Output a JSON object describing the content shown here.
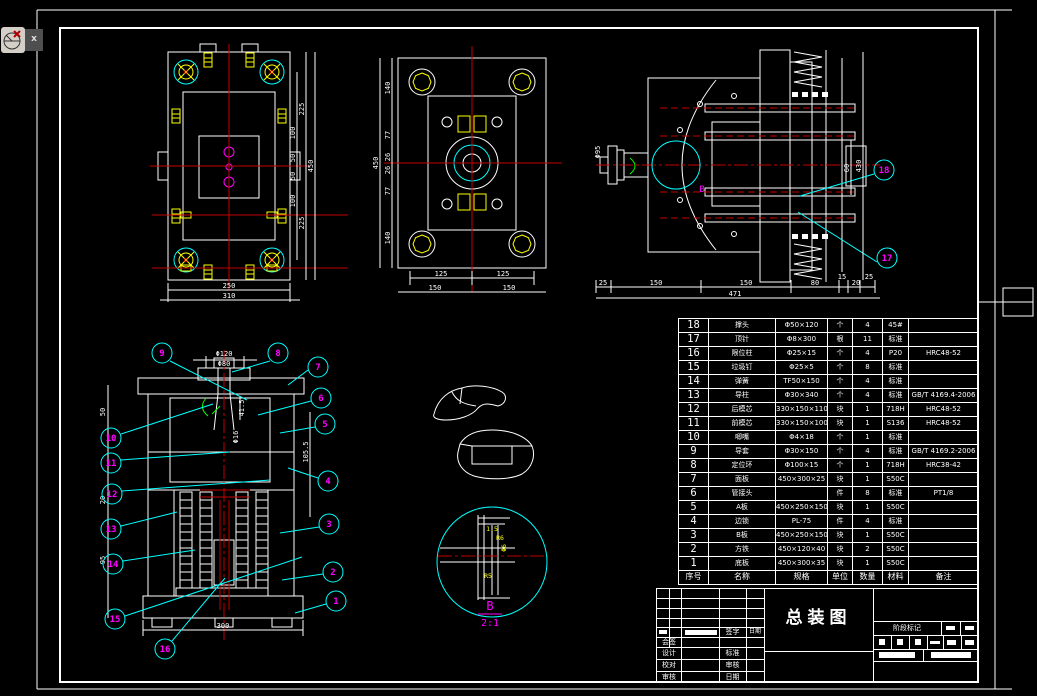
{
  "window": {
    "close_button": "x"
  },
  "views": {
    "plan_view_1": {
      "dim_bottom_inner": "250",
      "dim_bottom_outer": "310",
      "dims_right_chain": [
        "100",
        "50",
        "50",
        "100"
      ],
      "dims_right_mid": [
        "225",
        "225"
      ],
      "dim_right_total": "450"
    },
    "plan_view_2": {
      "dims_left_chain": [
        "140",
        "77",
        "26",
        "26",
        "77",
        "140"
      ],
      "dim_left_total": "450",
      "dims_bottom_inner": [
        "125",
        "125"
      ],
      "dims_bottom_outer": [
        "150",
        "150"
      ]
    },
    "section_view": {
      "dims_bottom_chain": [
        "25",
        "150",
        "150",
        "80",
        "15",
        "20",
        "25"
      ],
      "dim_bottom_total": "471",
      "dim_right_1": "60",
      "dim_right_2": "430",
      "dim_left": "Φ95",
      "detail_label": "B",
      "balloons": {
        "b17": "17",
        "b18": "18"
      }
    },
    "front_view": {
      "dim_top_1": "Φ120",
      "dim_top_2": "Φ80",
      "dim_side_right": "105.5",
      "dim_inner_1": "41.5",
      "dim_inner_2": "Φ16",
      "dim_bottom": "300",
      "dims_left": [
        "50",
        "20",
        "95"
      ],
      "balloons": {
        "b1": "1",
        "b2": "2",
        "b3": "3",
        "b4": "4",
        "b5": "5",
        "b6": "6",
        "b7": "7",
        "b8": "8",
        "b9": "9",
        "b10": "10",
        "b11": "11",
        "b12": "12",
        "b13": "13",
        "b14": "14",
        "b15": "15",
        "b16": "16"
      }
    },
    "detail_view": {
      "label": "B",
      "scale": "2:1",
      "dims": [
        "1.5",
        "R6",
        "Φ6",
        "R5"
      ]
    }
  },
  "parts_table": {
    "headers": [
      "序号",
      "名称",
      "规格",
      "单位",
      "数量",
      "材料",
      "备注"
    ],
    "rows": [
      [
        "18",
        "撑头",
        "Φ50×120",
        "个",
        "4",
        "45#",
        ""
      ],
      [
        "17",
        "顶针",
        "Φ8×300",
        "根",
        "11",
        "标准",
        ""
      ],
      [
        "16",
        "限位柱",
        "Φ25×15",
        "个",
        "4",
        "P20",
        "HRC48-52"
      ],
      [
        "15",
        "垃圾钉",
        "Φ25×5",
        "个",
        "8",
        "标准",
        ""
      ],
      [
        "14",
        "弹簧",
        "TF50×150",
        "个",
        "4",
        "标准",
        ""
      ],
      [
        "13",
        "导柱",
        "Φ30×340",
        "个",
        "4",
        "标准",
        "GB/T 4169.4-2006"
      ],
      [
        "12",
        "后模芯",
        "330×150×110",
        "块",
        "1",
        "718H",
        "HRC48-52"
      ],
      [
        "11",
        "前模芯",
        "330×150×100",
        "块",
        "1",
        "S136",
        "HRC48-52"
      ],
      [
        "10",
        "唧嘴",
        "Φ4×18",
        "个",
        "1",
        "标准",
        ""
      ],
      [
        "9",
        "导套",
        "Φ30×150",
        "个",
        "4",
        "标准",
        "GB/T 4169.2-2006"
      ],
      [
        "8",
        "定位环",
        "Φ100×15",
        "个",
        "1",
        "718H",
        "HRC38-42"
      ],
      [
        "7",
        "面板",
        "450×300×25",
        "块",
        "1",
        "S50C",
        ""
      ],
      [
        "6",
        "管接头",
        "",
        "件",
        "8",
        "标准",
        "PT1/8"
      ],
      [
        "5",
        "A板",
        "450×250×150",
        "块",
        "1",
        "S50C",
        ""
      ],
      [
        "4",
        "边锁",
        "PL-75",
        "件",
        "4",
        "标准",
        ""
      ],
      [
        "3",
        "B板",
        "450×250×150",
        "块",
        "1",
        "S50C",
        ""
      ],
      [
        "2",
        "方铁",
        "450×120×40",
        "块",
        "2",
        "S50C",
        ""
      ],
      [
        "1",
        "底板",
        "450×300×35",
        "块",
        "1",
        "S50C",
        ""
      ]
    ]
  },
  "title_block": {
    "title": "总装图",
    "sign_label": "签字",
    "date_label": "日期",
    "countersign_label": "会签",
    "row_labels": [
      [
        "设计",
        "标准"
      ],
      [
        "校对",
        "审核"
      ],
      [
        "审核",
        "日期"
      ]
    ],
    "stage_label": "阶段标记"
  }
}
